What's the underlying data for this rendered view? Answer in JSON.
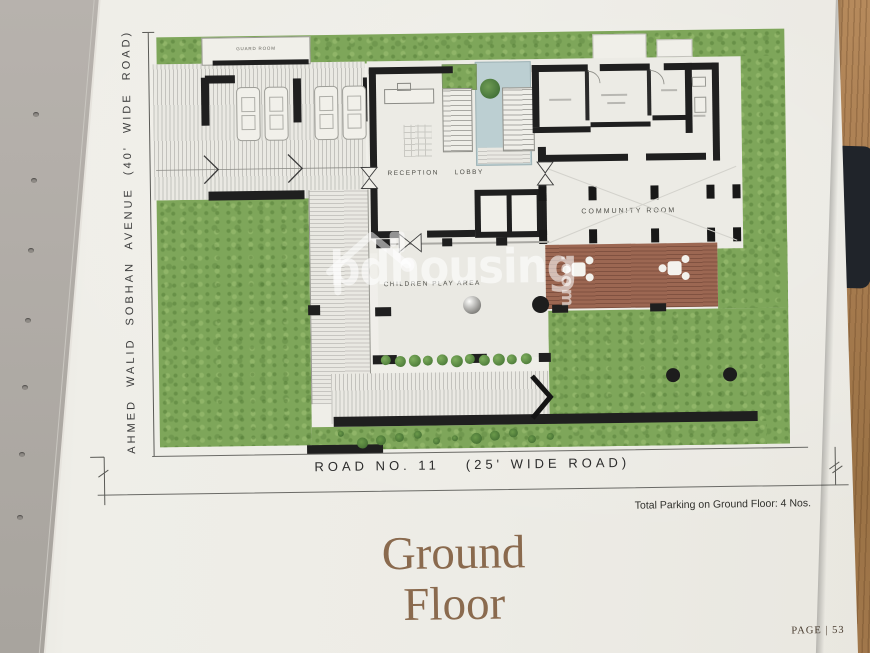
{
  "plan": {
    "left_road_label": "AHMED WALID SOBHAN AVENUE (40' WIDE ROAD)",
    "bottom_road": {
      "name": "ROAD NO. 11",
      "width": "(25' WIDE ROAD)"
    },
    "rooms": {
      "guard": "GUARD ROOM",
      "reception": "RECEPTION",
      "lobby": "LOBBY",
      "community": "COMMUNITY ROOM",
      "children": "CHILDREN PLAY AREA"
    },
    "counts": {
      "cars": 4,
      "planter_trees": 11,
      "community_columns": 5,
      "lawn_dots": 2
    }
  },
  "annotations": {
    "parking_note": "Total Parking on Ground Floor: 4 Nos."
  },
  "title": {
    "line1": "Ground",
    "line2": "Floor"
  },
  "footer": {
    "page_label": "PAGE | 53"
  },
  "watermark": {
    "part1": "bd",
    "part2": "housing",
    "part3": ".com"
  },
  "colors": {
    "lawn": "#7ea65a",
    "deck": "#9c6752",
    "walls": "#1f1f1f",
    "title_text": "#8a6a4e",
    "page": "#edece6",
    "wood": "#a87c50"
  }
}
